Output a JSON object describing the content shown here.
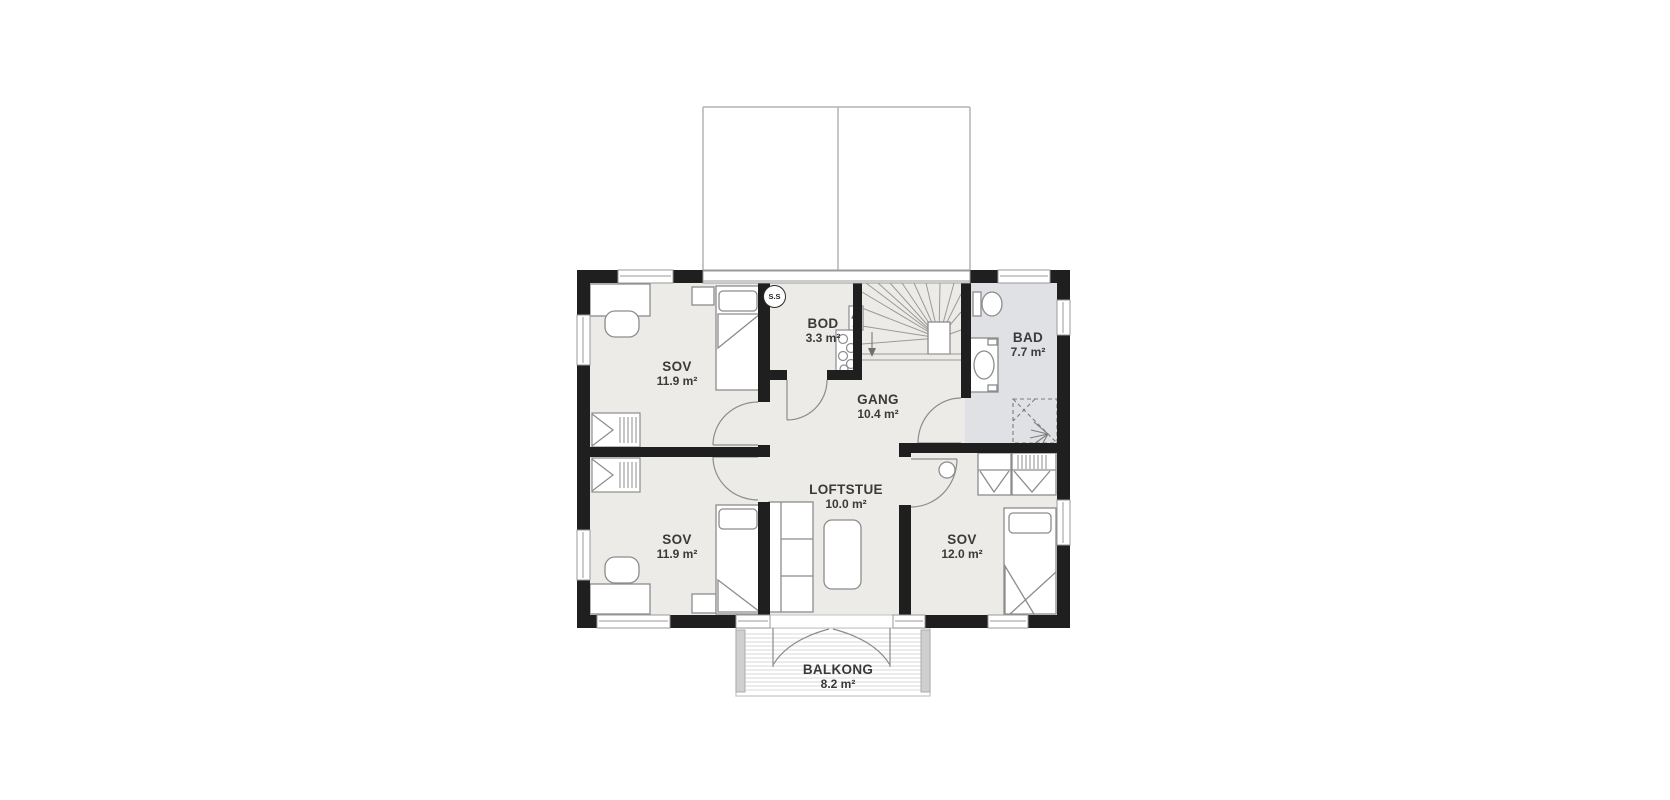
{
  "rooms": {
    "bedroom_top_left": {
      "name": "SOV",
      "area": "11.9 m²"
    },
    "bedroom_bottom_left": {
      "name": "SOV",
      "area": "11.9 m²"
    },
    "bedroom_bottom_right": {
      "name": "SOV",
      "area": "12.0 m²"
    },
    "bathroom": {
      "name": "BAD",
      "area": "7.7 m²"
    },
    "storage": {
      "name": "BOD",
      "area": "3.3 m²"
    },
    "hallway": {
      "name": "GANG",
      "area": "10.4 m²"
    },
    "loft_living_room": {
      "name": "LOFTSTUE",
      "area": "10.0 m²"
    },
    "balcony": {
      "name": "BALKONG",
      "area": "8.2 m²"
    }
  },
  "markers": {
    "shaft_marker": "S.S"
  },
  "colors": {
    "wall": "#1f1f1f",
    "room_floor": "#edebe7",
    "bathroom_floor": "#e0e1e4",
    "furniture_line": "#8c8c8c",
    "dormer_line": "#b3b3b3",
    "balcony_plank": "#d8d8d8",
    "text": "#3a3a3a"
  }
}
